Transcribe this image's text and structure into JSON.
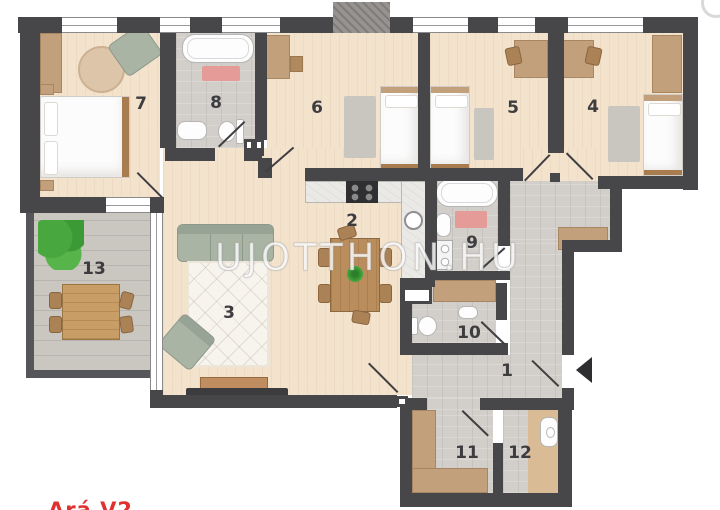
{
  "watermark": {
    "text": "UJOTTHON.HU"
  },
  "footer": {
    "clipped_red_text": "Ará V2"
  },
  "room_labels": {
    "r1": "1",
    "r2": "2",
    "r3": "3",
    "r4": "4",
    "r5": "5",
    "r6": "6",
    "r7": "7",
    "r8": "8",
    "r9": "9",
    "r10": "10",
    "r11": "11",
    "r12": "12",
    "r13": "13"
  },
  "colors": {
    "wall": "#47474a",
    "wood_floor": "#f4e3cc",
    "tile_floor": "#d2cec9",
    "balcony_floor": "#cac6c0",
    "furniture_tan": "#c2a07c",
    "sofa_sage": "#a9b4a5",
    "rug_pink": "#e59b97",
    "plant_green": "#3ea23a",
    "label_text": "#3d3d40",
    "watermark_white": "#ffffff",
    "red_text": "#e03131"
  }
}
